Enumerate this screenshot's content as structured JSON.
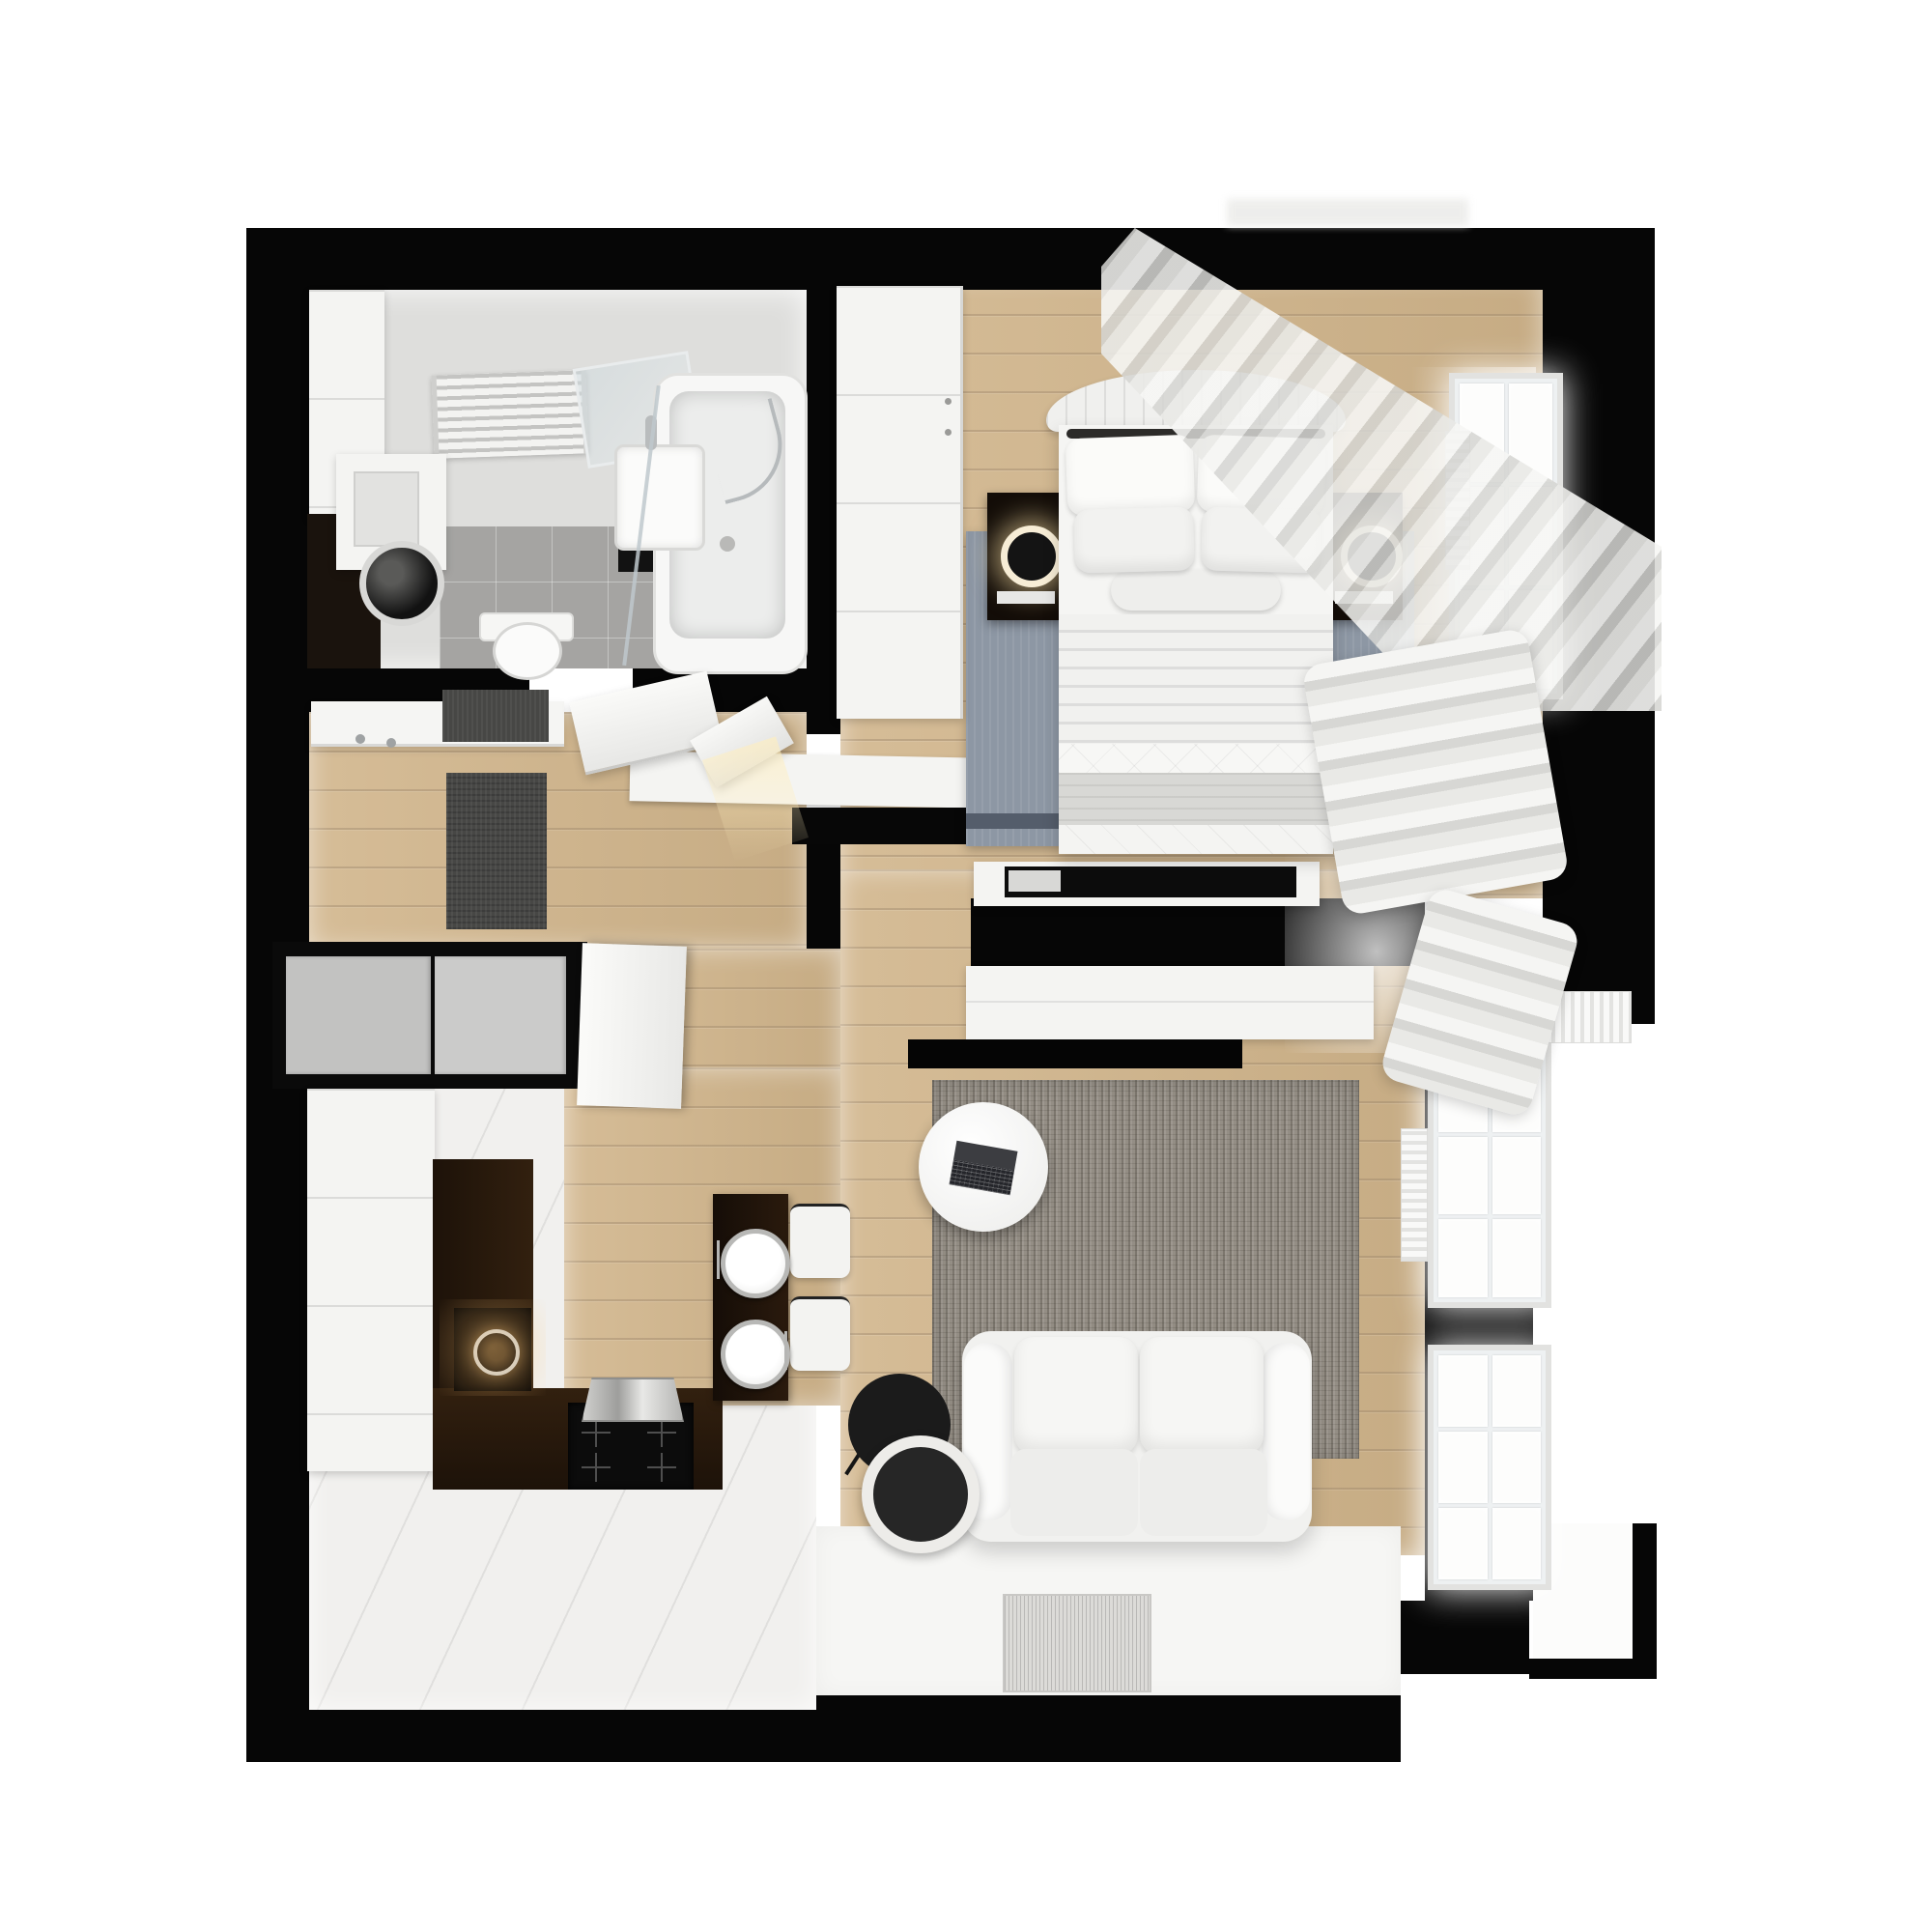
{
  "scene": {
    "title": "apartment-floor-plan-3d-top-view",
    "view": "top-down-render",
    "visible_text": []
  },
  "palette": {
    "page_bg": "#ffffff",
    "wall": "#060606",
    "wood": "#d1b58b",
    "tile": "#f1f0ee",
    "floor_white": "#f6f6f4",
    "bath_floor": "#dededc",
    "bath_tile": "#a5a4a2",
    "rug_bed": "#8d97a4",
    "rug_bed_edge": "#545d6b",
    "rug_living": "#948e85",
    "counter_dark": "#27190f",
    "appliance_black": "#0c0c0c",
    "furniture_white": "#f4f4f2",
    "closet_gray": "#c2c2c1",
    "mat_dark": "#474745",
    "glow_warm": "#ffe6aa"
  },
  "rooms": [
    {
      "name": "bathroom",
      "items": [
        "towel-radiator",
        "mirror",
        "washbasin",
        "washing-machine",
        "toilet",
        "bathtub",
        "shower-glass",
        "side-cabinets"
      ]
    },
    {
      "name": "hallway",
      "items": [
        "coat-rack",
        "entry-mats",
        "open-door-leaves",
        "closet-niche-gray-doors"
      ]
    },
    {
      "name": "kitchen",
      "items": [
        "tall-cabinet-column",
        "l-shaped-dark-counter",
        "sink",
        "cooktop",
        "extractor-hood",
        "bar-table",
        "two-plates",
        "two-bar-stools"
      ]
    },
    {
      "name": "bedroom",
      "items": [
        "double-bed",
        "tufted-headboard",
        "four-pillows",
        "bolster",
        "gray-throw",
        "two-nightstands",
        "glowing-table-lamps",
        "wardrobe",
        "blue-gray-rug",
        "tv-on-divider",
        "window",
        "radiator",
        "sheer-curtains"
      ]
    },
    {
      "name": "living-room",
      "items": [
        "media-wall",
        "white-tv-console",
        "mottled-gray-rug",
        "round-coffee-table",
        "laptop",
        "two-seat-white-sofa",
        "black-floor-lamp",
        "white-door-mat",
        "two-windows",
        "radiators",
        "curtain-pile"
      ]
    },
    {
      "name": "balcony-niche",
      "items": [
        "white-floor-step"
      ]
    }
  ]
}
